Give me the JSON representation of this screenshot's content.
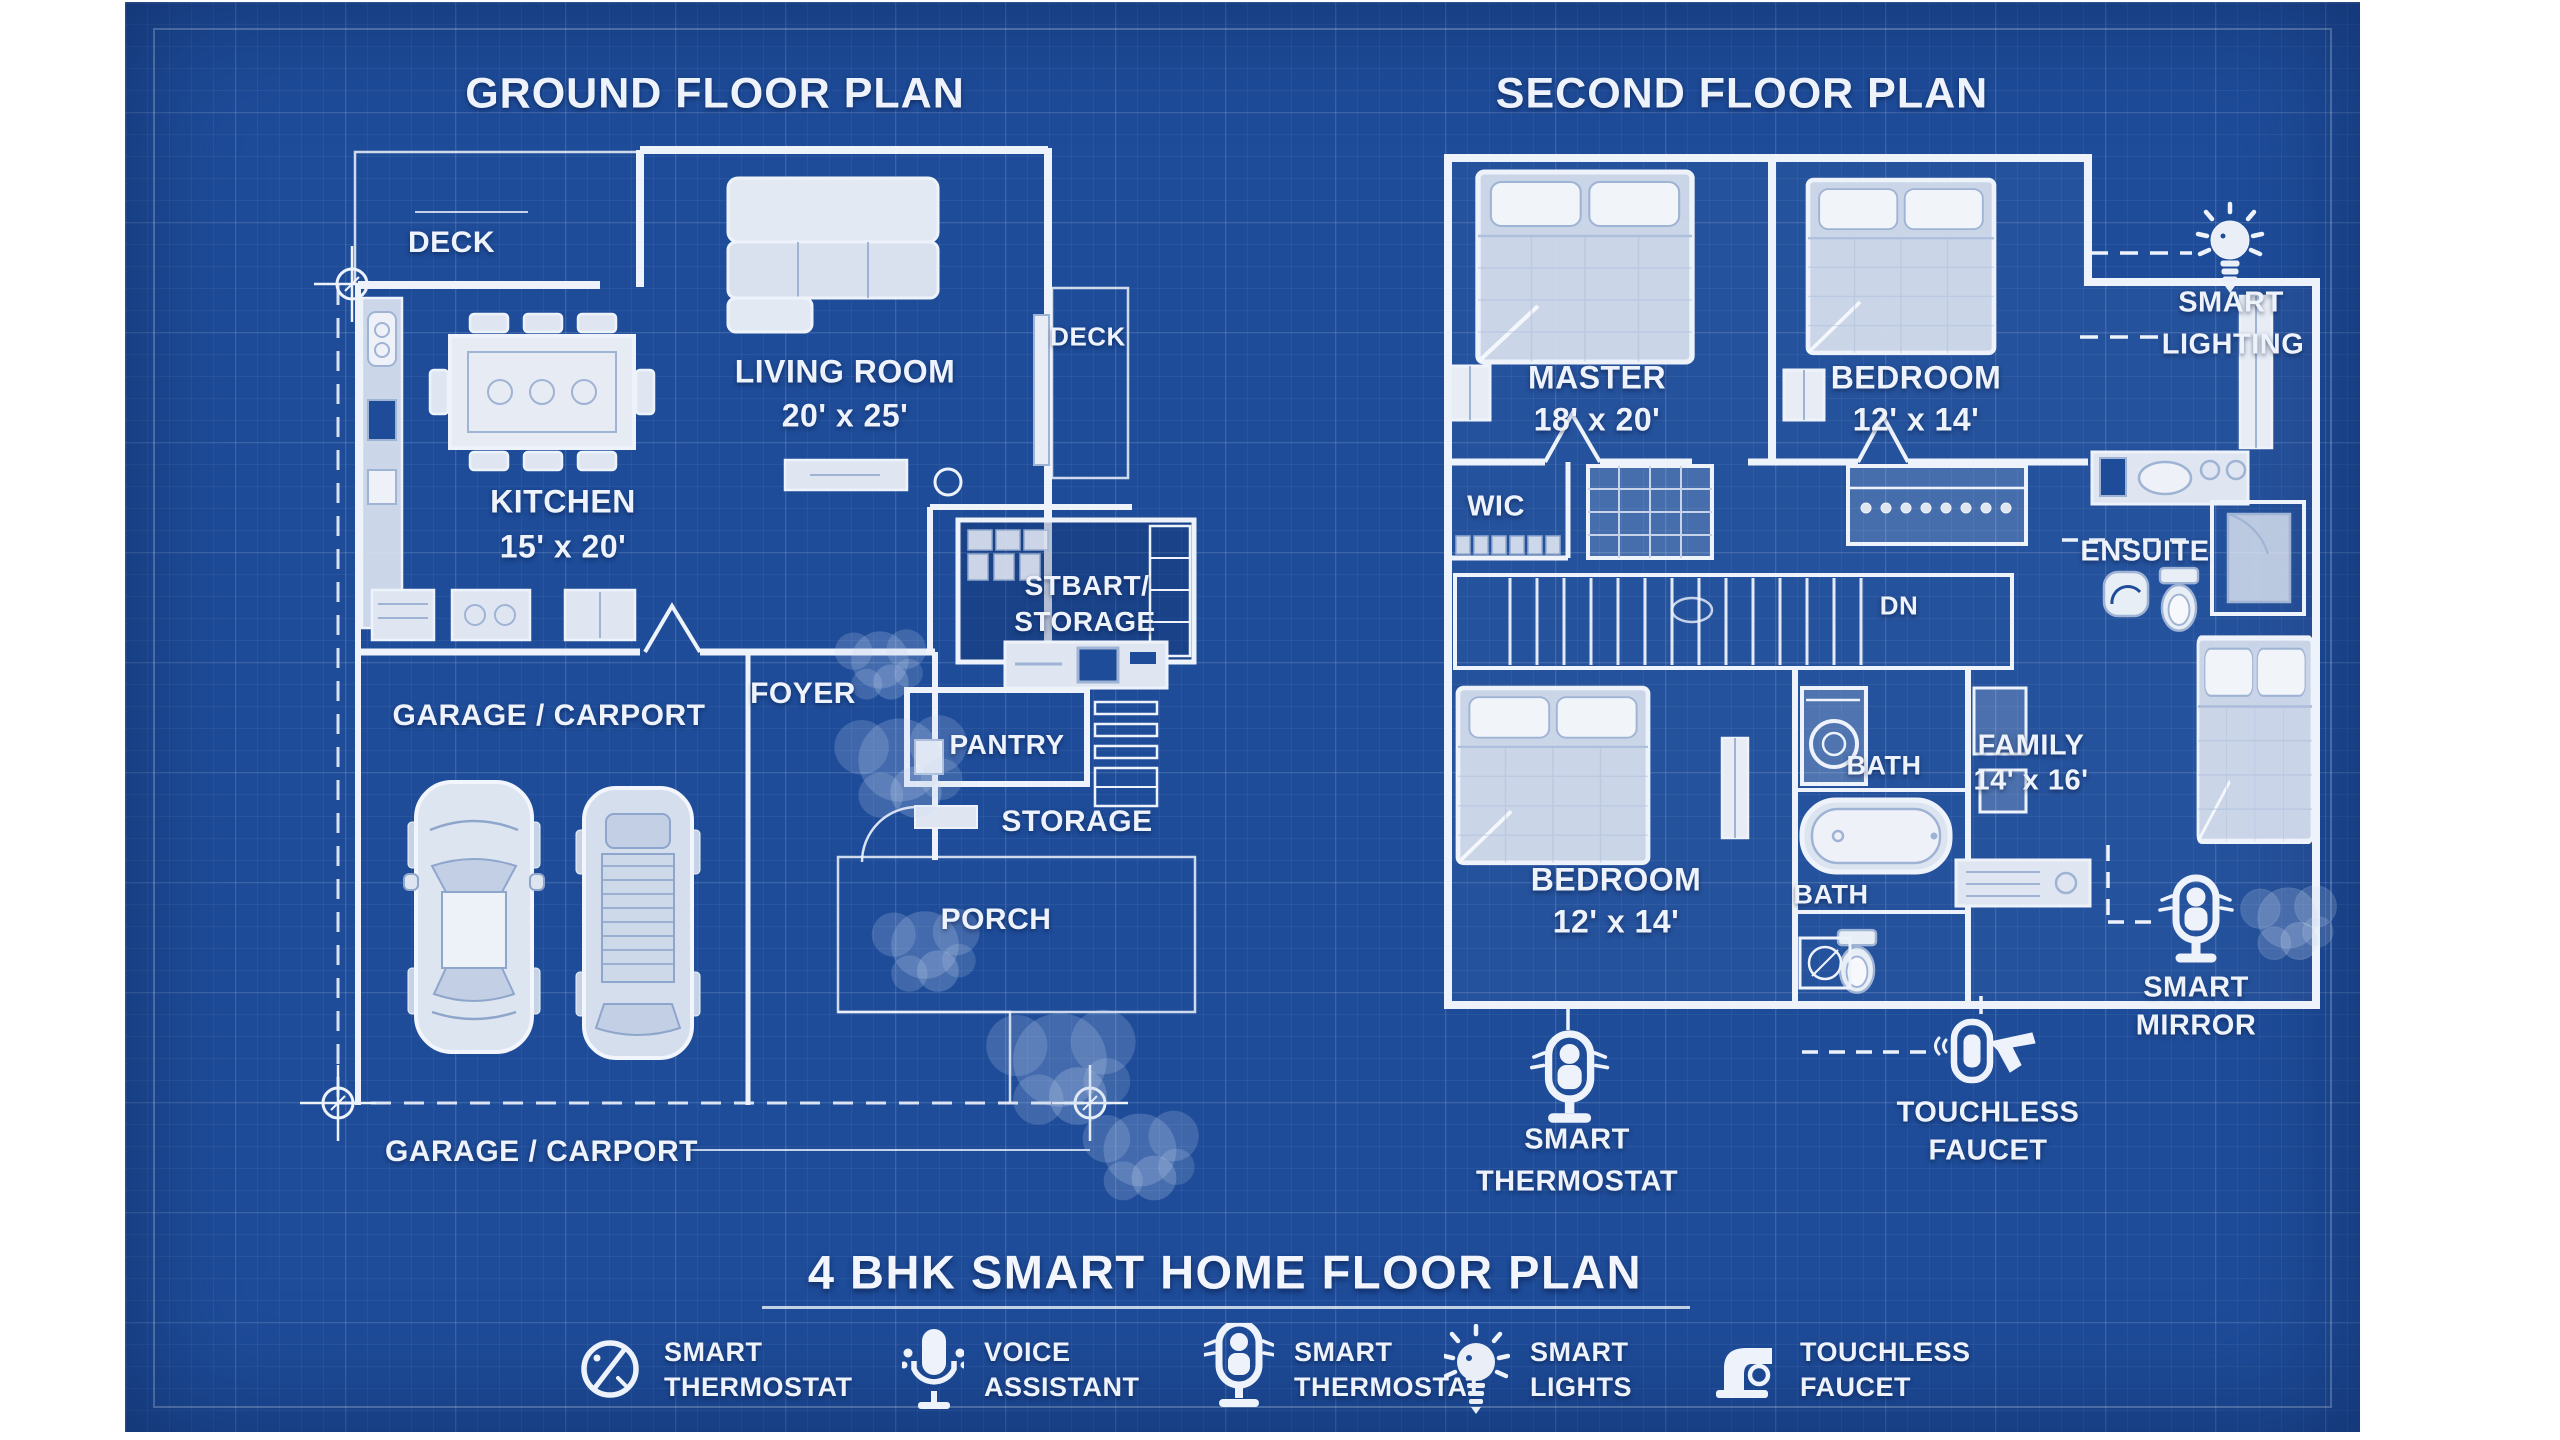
{
  "colors": {
    "paper": "#ffffff",
    "blueprint_background": "#1e4c99",
    "line": "#eef3fb"
  },
  "ground_floor": {
    "title": "GROUND FLOOR PLAN",
    "labels": {
      "deck_top": "DECK",
      "deck_right": "DECK",
      "living_room": "LIVING ROOM",
      "living_room_dims": "20' x 25'",
      "kitchen": "KITCHEN",
      "kitchen_dims": "15' x 20'",
      "garage": "GARAGE / CARPORT",
      "foyer": "FOYER",
      "smart_storage_line1": "STBART/",
      "smart_storage_line2": "STORAGE",
      "pantry": "PANTRY",
      "storage": "STORAGE",
      "porch": "PORCH",
      "boundary": "GARAGE / CARPORT"
    }
  },
  "second_floor": {
    "title": "SECOND FLOOR PLAN",
    "labels": {
      "master": "MASTER",
      "master_dims": "18' x 20'",
      "bedroom2": "BEDROOM",
      "bedroom2_dims": "12' x 14'",
      "wic": "WIC",
      "dn": "DN",
      "ensuite": "ENSUITE",
      "bedroom3": "BEDROOM",
      "bedroom3_dims": "12' x 14'",
      "bath_upper": "BATH",
      "bath_lower": "BATH",
      "family": "FAMILY",
      "family_dims": "14' x 16'"
    }
  },
  "callouts": {
    "smart_lighting": {
      "line1": "SMART",
      "line2": "LIGHTING"
    },
    "smart_mirror": {
      "line1": "SMART",
      "line2": "MIRROR"
    },
    "touchless_faucet": {
      "line1": "TOUCHLESS",
      "line2": "FAUCET"
    },
    "smart_thermostat": {
      "line1": "SMART",
      "line2": "THERMOSTAT"
    }
  },
  "footer": {
    "title": "4 BHK SMART HOME FLOOR PLAN",
    "legend": [
      {
        "icon": "smart-thermostat-gauge-icon",
        "line1": "SMART",
        "line2": "THERMOSTAT"
      },
      {
        "icon": "voice-assistant-mic-icon",
        "line1": "VOICE",
        "line2": "ASSISTANT"
      },
      {
        "icon": "smart-thermostat-device-icon",
        "line1": "SMART",
        "line2": "THERMOSTAT"
      },
      {
        "icon": "smart-lights-bulb-icon",
        "line1": "SMART",
        "line2": "LIGHTS"
      },
      {
        "icon": "touchless-faucet-icon",
        "line1": "TOUCHLESS",
        "line2": "FAUCET"
      }
    ]
  }
}
